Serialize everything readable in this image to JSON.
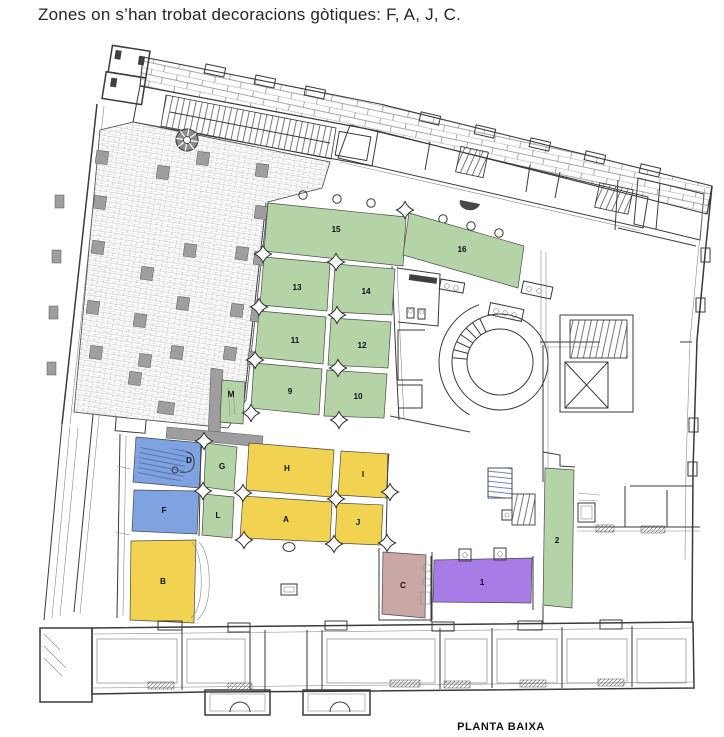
{
  "title": "Zones on s’han trobat decoracions gòtiques: F, A, J, C.",
  "caption": "PLANTA BAIXA",
  "gothic_zones": [
    "F",
    "A",
    "J",
    "C"
  ],
  "colors": {
    "green": "#b4d3a7",
    "yellow": "#f2d351",
    "blue": "#7fa3e0",
    "purple": "#a87ce7",
    "mauve": "#c9a7a4"
  },
  "zones": [
    {
      "id": "15",
      "label": "15",
      "color": "green",
      "points": "268,203 406,217 403,266 264,251",
      "lx": 336,
      "ly": 232
    },
    {
      "id": "16",
      "label": "16",
      "color": "green",
      "points": "409,213 524,246 518,288 403,255",
      "lx": 462,
      "ly": 252
    },
    {
      "id": "13",
      "label": "13",
      "color": "green",
      "points": "264,257 330,263 327,311 260,305",
      "lx": 297,
      "ly": 290
    },
    {
      "id": "14",
      "label": "14",
      "color": "green",
      "points": "335,264 395,269 392,315 332,312",
      "lx": 366,
      "ly": 294
    },
    {
      "id": "11",
      "label": "11",
      "color": "green",
      "points": "259,311 326,317 323,364 255,357",
      "lx": 295,
      "ly": 343
    },
    {
      "id": "12",
      "label": "12",
      "color": "green",
      "points": "331,318 391,322 388,368 328,365",
      "lx": 362,
      "ly": 348
    },
    {
      "id": "9",
      "label": "9",
      "color": "green",
      "points": "254,363 322,369 319,415 251,408",
      "lx": 290,
      "ly": 394
    },
    {
      "id": "10",
      "label": "10",
      "color": "green",
      "points": "327,370 387,374 384,418 324,416",
      "lx": 358,
      "ly": 399
    },
    {
      "id": "M",
      "label": "M",
      "color": "green",
      "points": "222,380 245,382 243,424 220,422",
      "lx": 231,
      "ly": 397
    },
    {
      "id": "G",
      "label": "G",
      "color": "green",
      "points": "206,443 237,447 234,491 204,487",
      "lx": 222,
      "ly": 469
    },
    {
      "id": "L",
      "label": "L",
      "color": "green",
      "points": "204,494 234,497 232,538 202,535",
      "lx": 218,
      "ly": 518
    },
    {
      "id": "H",
      "label": "H",
      "color": "yellow",
      "points": "249,443 334,450 331,497 246,490",
      "lx": 287,
      "ly": 471
    },
    {
      "id": "I",
      "label": "I",
      "color": "yellow",
      "points": "341,451 389,454 386,498 338,495",
      "lx": 363,
      "ly": 477
    },
    {
      "id": "A",
      "label": "A",
      "color": "yellow",
      "points": "243,496 332,502 330,542 240,538",
      "lx": 286,
      "ly": 522
    },
    {
      "id": "J",
      "label": "J",
      "color": "yellow",
      "points": "337,503 383,505 381,545 335,543",
      "lx": 358,
      "ly": 525
    },
    {
      "id": "D",
      "label": "D",
      "color": "blue",
      "points": "136,437 202,443 199,488 133,482",
      "lx": 189,
      "ly": 463
    },
    {
      "id": "F",
      "label": "F",
      "color": "blue",
      "points": "134,490 199,491 197,534 132,531",
      "lx": 164,
      "ly": 513
    },
    {
      "id": "B",
      "label": "B",
      "color": "yellow",
      "points": "131,541 196,540 194,623 130,620",
      "lx": 163,
      "ly": 584
    },
    {
      "id": "C",
      "label": "C",
      "color": "mauve",
      "points": "383,552 426,555 425,618 382,614",
      "lx": 403,
      "ly": 588
    },
    {
      "id": "1",
      "label": "1",
      "color": "purple",
      "points": "434,560 532,558 531,603 433,602",
      "lx": 482,
      "ly": 585
    },
    {
      "id": "2",
      "label": "2",
      "color": "green",
      "points": "545,468 574,470 572,608 543,605",
      "lx": 557,
      "ly": 543
    }
  ]
}
